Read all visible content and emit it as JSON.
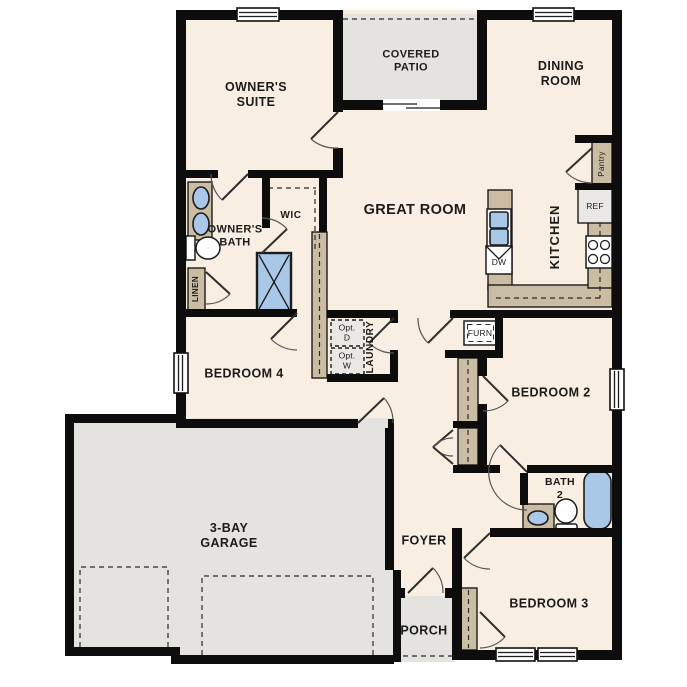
{
  "plan": {
    "rooms": {
      "owners_suite": "OWNER'S\nSUITE",
      "covered_patio": "COVERED\nPATIO",
      "dining_room": "DINING\nROOM",
      "great_room": "GREAT ROOM",
      "kitchen": "KITCHEN",
      "owners_bath": "OWNER'S\nBATH",
      "wic": "WIC",
      "linen": "LINEN",
      "pantry": "Pantry",
      "bedroom_4": "BEDROOM 4",
      "laundry": "LAUNDRY",
      "bedroom_2": "BEDROOM 2",
      "bath_2": "BATH\n2",
      "bedroom_3": "BEDROOM 3",
      "foyer": "FOYER",
      "porch": "PORCH",
      "garage": "3-BAY\nGARAGE"
    },
    "appliances": {
      "ref": "REF",
      "dw": "DW",
      "furn": "FURN",
      "opt_dryer": "Opt.\nD",
      "opt_washer": "Opt.\nW"
    },
    "colors": {
      "floor": "#f8efe2",
      "outdoor": "#e4e3e0",
      "cabinet": "#cbbda4",
      "fixture": "#a9c8e8",
      "appliance": "#e9e8e5",
      "wall": "#0d0d0d",
      "ink": "#1b1b1b"
    }
  }
}
